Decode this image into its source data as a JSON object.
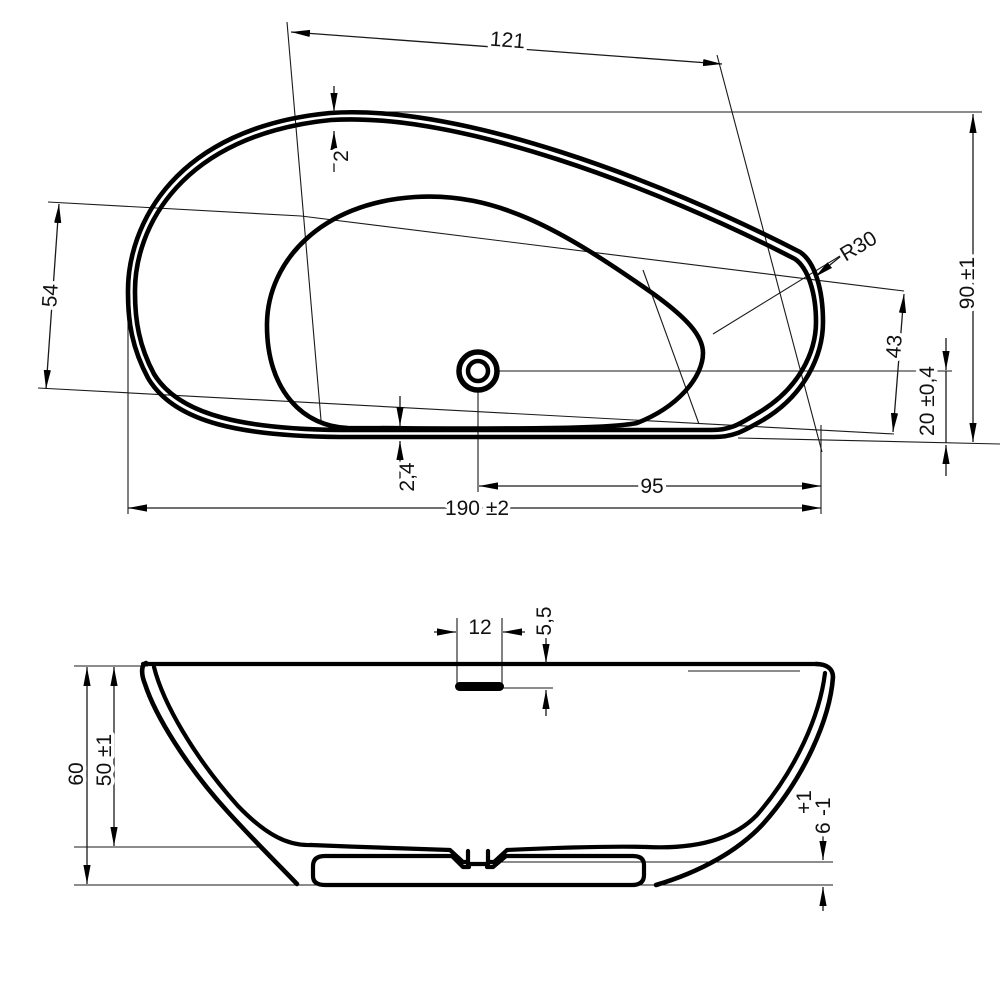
{
  "drawing": {
    "colors": {
      "line": "#000000",
      "background": "#ffffff"
    },
    "plan_view": {
      "dimensions": {
        "inner_length": "121",
        "rim_thickness": "2",
        "inner_width": "54",
        "corner_radius": "R30",
        "overall_width": "90 ±1",
        "drain_to_inner_edge": "43",
        "drain_to_outer_edge": "20 ±0,4",
        "drain_to_right_end": "95",
        "bottom_rim_gap": "2,4",
        "overall_length": "190 ±2"
      }
    },
    "side_view": {
      "dimensions": {
        "overflow_width": "12",
        "overflow_depth": "5,5",
        "overall_height": "60",
        "rim_to_base": "50 ±1",
        "base_clearance_value": "6",
        "base_clearance_plus": "+1",
        "base_clearance_minus": "-1"
      }
    }
  }
}
